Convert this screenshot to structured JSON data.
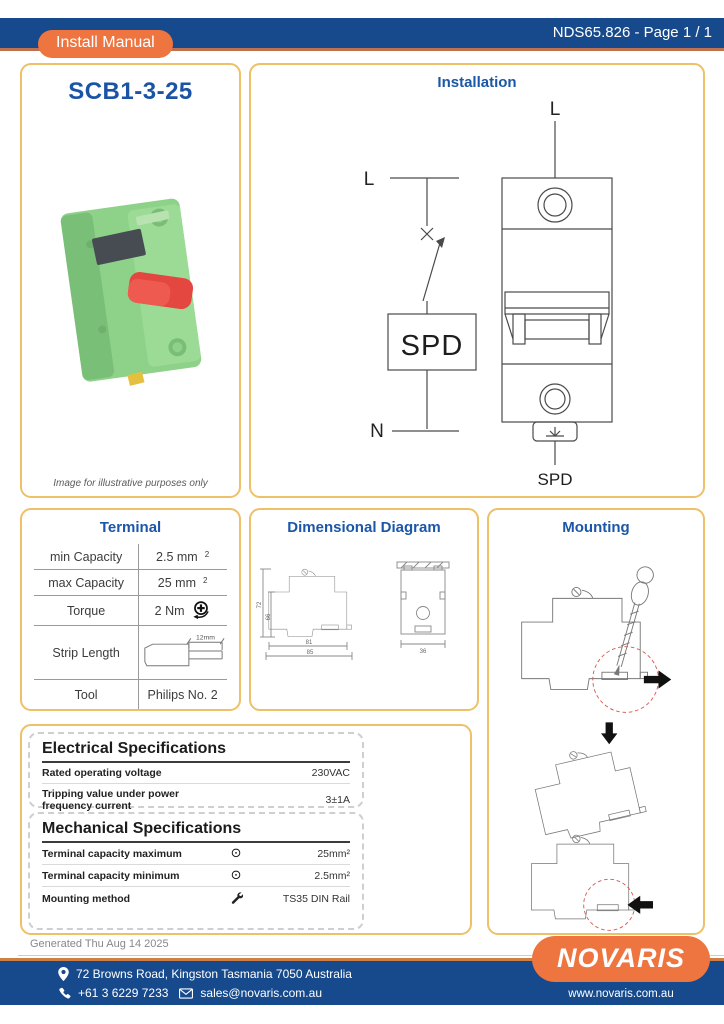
{
  "colors": {
    "navy": "#174a8c",
    "orange": "#ee7540",
    "box_border": "#eec068",
    "heading_blue": "#1b56a8",
    "accent_red": "#d9564d"
  },
  "header": {
    "doc_ref": "NDS65.826 - Page 1 / 1",
    "badge": "Install Manual"
  },
  "product": {
    "title": "SCB1-3-25",
    "caption": "Image for illustrative purposes only"
  },
  "installation": {
    "title": "Installation",
    "schematic": {
      "line": "L",
      "neutral": "N",
      "spd": "SPD"
    },
    "device": {
      "top_label": "L",
      "bottom_label": "SPD"
    }
  },
  "terminal": {
    "title": "Terminal",
    "rows": [
      {
        "label": "min Capacity",
        "value": "2.5 mm",
        "sup": "2"
      },
      {
        "label": "max Capacity",
        "value": "25 mm",
        "sup": "2"
      },
      {
        "label": "Torque",
        "value": "2 Nm"
      },
      {
        "label": "Strip Length",
        "dim": "12mm"
      },
      {
        "label": "Tool",
        "value": "Philips No. 2"
      }
    ]
  },
  "dimensional": {
    "title": "Dimensional Diagram",
    "dims": {
      "height_outer": "72",
      "height_inner": "66",
      "width_inner": "81",
      "width_outer": "85",
      "depth": "36"
    }
  },
  "mounting": {
    "title": "Mounting"
  },
  "electrical": {
    "title": "Electrical Specifications",
    "rows": [
      {
        "label": "Rated operating voltage",
        "value": "230VAC"
      },
      {
        "label": "Tripping value under power frequency current",
        "value": "3±1A"
      }
    ]
  },
  "mechanical": {
    "title": "Mechanical Specifications",
    "rows": [
      {
        "label": "Terminal capacity maximum",
        "icon": "terminal-screw-icon",
        "value": "25mm²"
      },
      {
        "label": "Terminal capacity minimum",
        "icon": "terminal-screw-icon",
        "value": "2.5mm²"
      },
      {
        "label": "Mounting method",
        "icon": "wrench-icon",
        "value": "TS35 DIN Rail"
      }
    ]
  },
  "footer": {
    "generated": "Generated Thu Aug 14 2025",
    "address": "72 Browns Road, Kingston Tasmania 7050 Australia",
    "phone": "+61 3 6229 7233",
    "email": "sales@novaris.com.au",
    "logo_text": "NOVARIS",
    "website": "www.novaris.com.au"
  }
}
